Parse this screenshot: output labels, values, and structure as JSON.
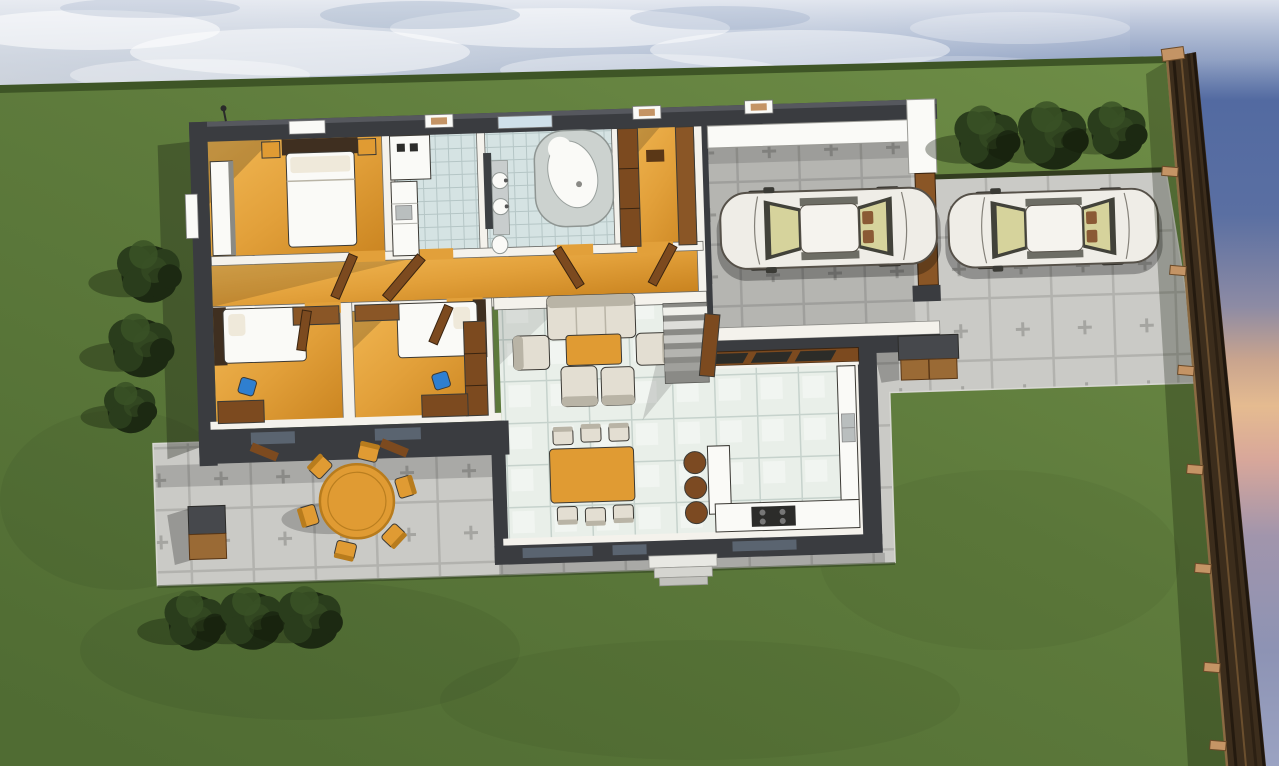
{
  "app": {
    "type": "architectural-3d-render",
    "view": "aerial-top-down-cutaway",
    "description": "3D rendered site plan of a single-storey house with garden lawn, stone patio, carport, driveway, two cars, wooden boundary fence and shrubs at dusk"
  },
  "canvas": {
    "width": 1279,
    "height": 766
  },
  "colors": {
    "skyTop": "#cdd2da",
    "skyMid": "#b4bfd1",
    "skyBlue": "#8ea0c0",
    "skyDeep": "#5f77a8",
    "skyNavy": "#4c66a0",
    "sunsetPeach": "#e5bb90",
    "sunsetRose": "#d8a79a",
    "sunsetMauve": "#a195ac",
    "duskBlue": "#8d93b4",
    "duskLight": "#9ba3c2",
    "cloudWhite": "#ffffff",
    "cloudSlate": "#7d92b5",
    "lawnLight": "#6d8c46",
    "lawn": "#5e7b3c",
    "lawnDark": "#506c33",
    "lawnEdge": "#3e5526",
    "paver": "#cacac6",
    "paverLine": "#b2b2ae",
    "paverCross": "#a5a5a1",
    "paverEdge": "#d8d8d3",
    "wallDark": "#3a3c40",
    "wallTop": "#56585e",
    "wallWhite": "#f4f2ec",
    "wallShade": "#d9d6cd",
    "woodLight": "#f2b854",
    "wood": "#e2a03a",
    "woodDark": "#c9831f",
    "tile": "#e9efe9",
    "tileLine": "#c6d2cc",
    "bathTile": "#d5e3e3",
    "bathTileLine": "#b5c6c6",
    "fixtureWhite": "#fafaf7",
    "fixtureGrey": "#c8cdcd",
    "mirrorDark": "#3c4043",
    "doorBrown": "#7c4a1f",
    "wardrobeBrown": "#8a5626",
    "headboardBrown": "#3f2f20",
    "sofaCream": "#e3ded2",
    "sofaShade": "#b9b4a6",
    "furnitureOutline": "#3c3a35",
    "tableOrange": "#e09b33",
    "tableOrangeDark": "#b87c1d",
    "stoolBrown": "#7c4a22",
    "blueAccent": "#2f7fd0",
    "carBody": "#efede7",
    "carOutline": "#565149",
    "carGlass": "#d6d39c",
    "carGlassDark": "#42423a",
    "carSeat": "#8a5a35",
    "fenceDark": "#3c2d1c",
    "fenceMid": "#6b4f2e",
    "fenceLight": "#8a6a42",
    "fenceShadowLine": "#241a0f",
    "fencePost": "#c49465",
    "bushDark": "#1c2912",
    "bushMid": "#2a3d1c",
    "bushLight": "#3a5226",
    "windowSlate": "#5a6470",
    "stepGrey": "#8a8a86",
    "boxBrown": "#9a6a35",
    "boxDark": "#46484c",
    "retainEdge": "#333d20"
  },
  "scene": {
    "sky": {
      "clouds": 8,
      "sunset_side": "right"
    },
    "fence": {
      "side": "right",
      "posts": 8,
      "material": "wood"
    },
    "hardscape": {
      "patio": "stone pavers",
      "driveway": "stone pavers"
    },
    "house": {
      "storeys": 1,
      "rooms": [
        {
          "id": "master-bedroom",
          "floor": "wood",
          "furniture": [
            "double-bed",
            "nightstands",
            "closet"
          ]
        },
        {
          "id": "kitchen",
          "floor": "tile",
          "furniture": [
            "fridge",
            "counter",
            "sink"
          ]
        },
        {
          "id": "bathroom",
          "floor": "tile",
          "furniture": [
            "corner-bathtub",
            "double-sink",
            "toilet",
            "mirror"
          ]
        },
        {
          "id": "dressing-room",
          "floor": "wood",
          "furniture": [
            "wardrobes"
          ]
        },
        {
          "id": "hallway",
          "floor": "wood",
          "furniture": [
            "doors"
          ]
        },
        {
          "id": "bedroom-2",
          "floor": "wood",
          "furniture": [
            "bed",
            "desk",
            "blue-chair",
            "wardrobe"
          ]
        },
        {
          "id": "bedroom-3",
          "floor": "wood",
          "furniture": [
            "bed",
            "desk",
            "blue-chair",
            "wardrobes"
          ]
        },
        {
          "id": "living-room",
          "floor": "ceramic-tile",
          "furniture": [
            "sofa",
            "armchairs",
            "coffee-table",
            "dining-table",
            "chairs"
          ]
        },
        {
          "id": "kitchenette-bar",
          "floor": "ceramic-tile",
          "furniture": [
            "bar-counter",
            "bar-stools",
            "counters",
            "cooktop",
            "sink"
          ]
        },
        {
          "id": "carport",
          "floor": "pavers",
          "furniture": [
            "car"
          ]
        }
      ]
    },
    "vehicles": [
      {
        "id": "car-in-carport",
        "transform": "translate(724 196)"
      },
      {
        "id": "car-on-driveway",
        "transform": "translate(952 204) scale(0.97)"
      }
    ],
    "landscaping": {
      "bushes": [
        {
          "transform": "translate(988 138) scale(1.12)"
        },
        {
          "transform": "translate(1054 136) scale(1.2)"
        },
        {
          "transform": "translate(1118 131) scale(1.02)"
        },
        {
          "transform": "translate(150 272) scale(1.1)"
        },
        {
          "transform": "translate(142 346) scale(1.12)"
        },
        {
          "transform": "translate(131 408) scale(0.9)"
        },
        {
          "transform": "translate(196 621) scale(1.05)"
        },
        {
          "transform": "translate(253 619) scale(1.1)"
        },
        {
          "transform": "translate(311 618) scale(1.1)"
        }
      ]
    },
    "outdoor_furniture": {
      "patio_round_table_seats": 6,
      "dining_seats": 6,
      "bar_stools": 3,
      "storage_boxes": 2
    }
  }
}
